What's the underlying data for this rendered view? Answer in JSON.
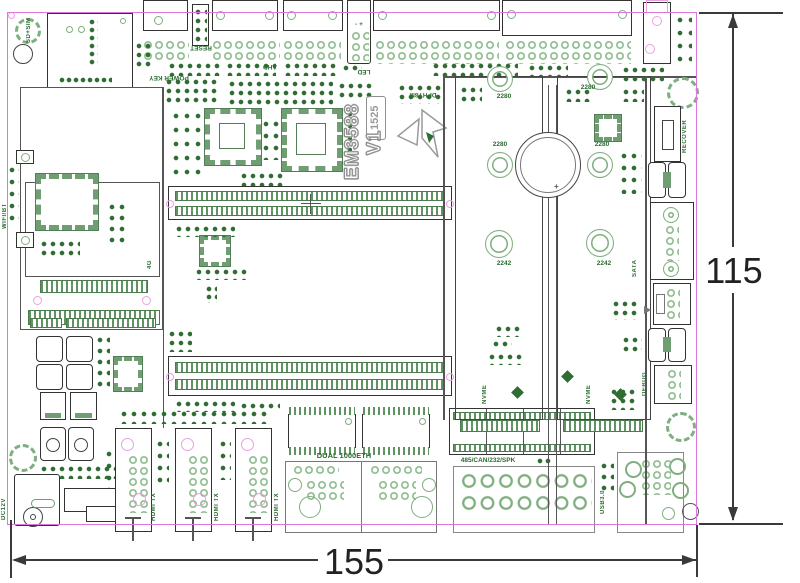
{
  "drawing": {
    "board_name": "EM3588 V1",
    "rev_code": "1525",
    "dim_width": "155",
    "dim_height": "115"
  },
  "labels": {
    "sd_sim": "SD+SIM",
    "reset": "RESET",
    "power_key": "POWER KEY",
    "ahd": "AHD",
    "led": "LED",
    "led_polarity": "- +",
    "dphy8m": "DPHY8M",
    "recover": "RECOVER",
    "wifi_bt": "WIFI/BT",
    "g4": "4G",
    "m2_2280": "2280",
    "m2_2242": "2242",
    "nvme": "NVME",
    "sata": "SATA",
    "debug": "DEBUG",
    "dc12v": "DC12V",
    "hdmi_tx": "HDMI TX",
    "dual_eth": "DUAL 1000ETH",
    "serial": "485/CAN/232/SPK",
    "usb3": "USB3.0",
    "battery_plus": "+"
  },
  "colors": {
    "board_outline": "#dd77dd",
    "silk_green_dark": "#2a6b2f",
    "silk_green_light": "#8fbc8f",
    "accent_pink": "#eaa0e2",
    "dimension": "#333333"
  }
}
